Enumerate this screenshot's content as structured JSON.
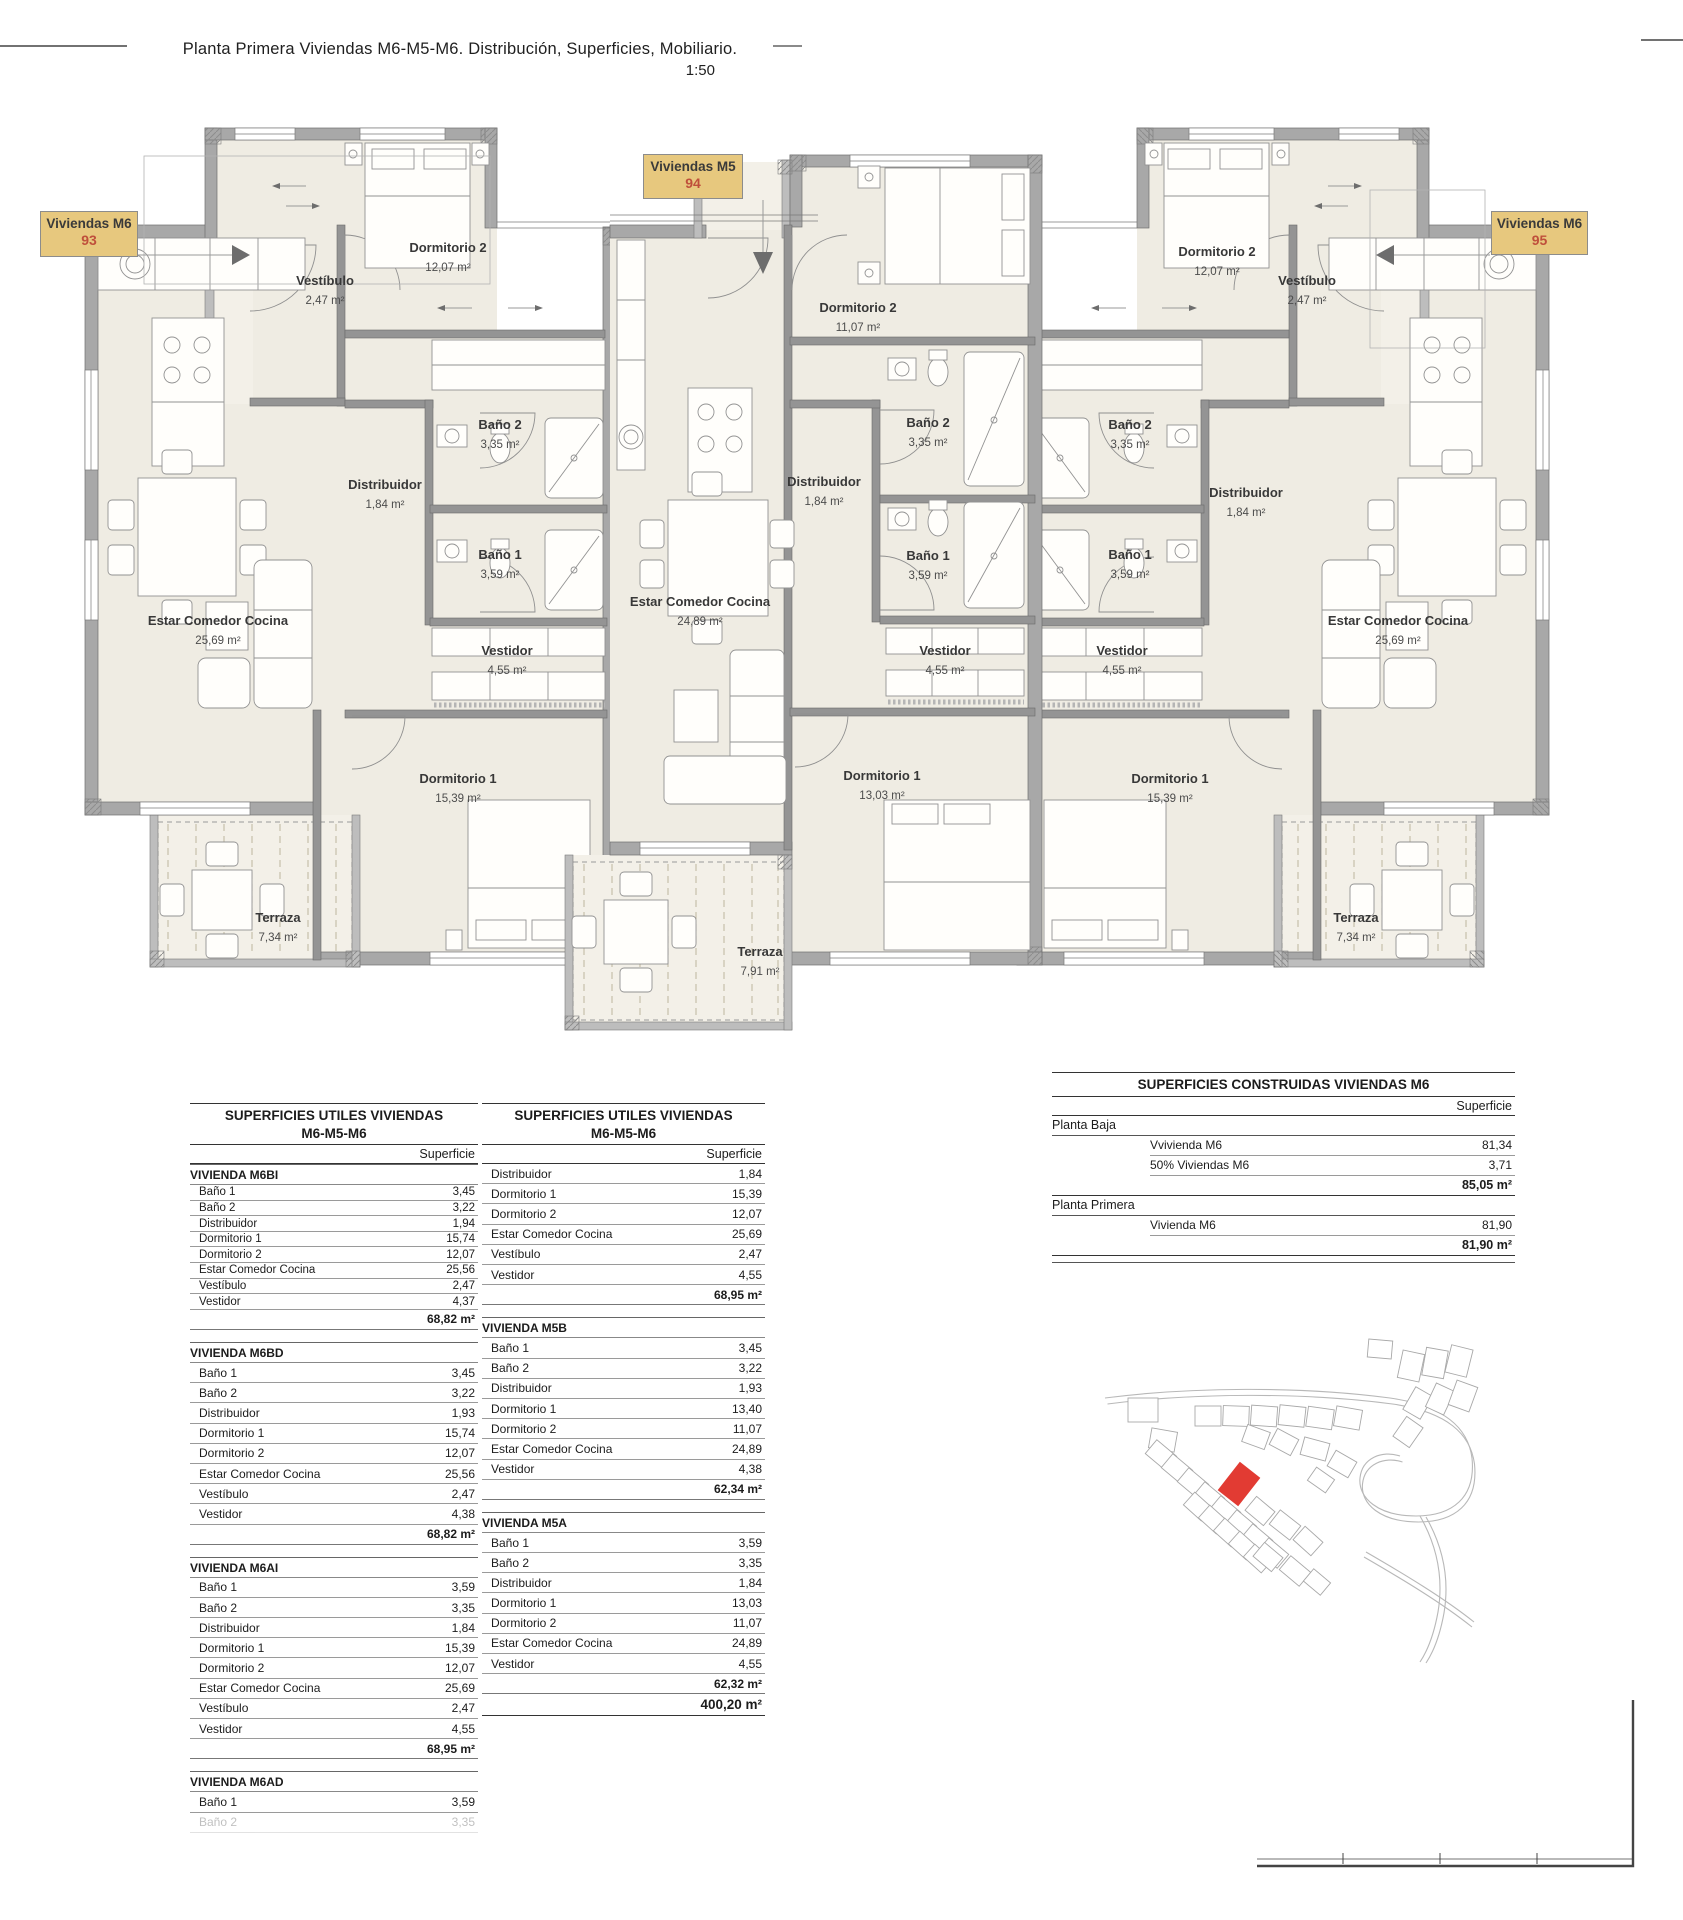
{
  "page": {
    "title": "Planta Primera Viviendas M6-M5-M6. Distribución, Superficies, Mobiliario.",
    "scale": "1:50"
  },
  "colors": {
    "tag_background": "#e7c87e",
    "tag_number": "#bf4f3b",
    "site_map_highlight": "#e23b33",
    "room_fill": "#efece3",
    "wall_gray": "#a8a8a8"
  },
  "unit_tags": [
    {
      "label": "Viviendas M6",
      "number": "93"
    },
    {
      "label": "Viviendas M5",
      "number": "94"
    },
    {
      "label": "Viviendas M6",
      "number": "95"
    }
  ],
  "plan": {
    "rooms": [
      {
        "unit": "m6-93",
        "name": "Vestíbulo",
        "area": "2,47 m²",
        "x": 325,
        "y": 285
      },
      {
        "unit": "m6-93",
        "name": "Dormitorio 2",
        "area": "12,07 m²",
        "x": 448,
        "y": 252
      },
      {
        "unit": "m6-93",
        "name": "Distribuidor",
        "area": "1,84 m²",
        "x": 385,
        "y": 489
      },
      {
        "unit": "m6-93",
        "name": "Baño 2",
        "area": "3,35 m²",
        "x": 500,
        "y": 429
      },
      {
        "unit": "m6-93",
        "name": "Baño 1",
        "area": "3,59 m²",
        "x": 500,
        "y": 559
      },
      {
        "unit": "m6-93",
        "name": "Vestidor",
        "area": "4,55 m²",
        "x": 507,
        "y": 655
      },
      {
        "unit": "m6-93",
        "name": "Estar Comedor Cocina",
        "area": "25,69 m²",
        "x": 218,
        "y": 625
      },
      {
        "unit": "m6-93",
        "name": "Dormitorio 1",
        "area": "15,39 m²",
        "x": 458,
        "y": 783
      },
      {
        "unit": "m6-93",
        "name": "Terraza",
        "area": "7,34 m²",
        "x": 278,
        "y": 922
      },
      {
        "unit": "m5-94",
        "name": "Dormitorio 2",
        "area": "11,07 m²",
        "x": 858,
        "y": 312
      },
      {
        "unit": "m5-94",
        "name": "Distribuidor",
        "area": "1,84 m²",
        "x": 824,
        "y": 486
      },
      {
        "unit": "m5-94",
        "name": "Baño 2",
        "area": "3,35 m²",
        "x": 928,
        "y": 427
      },
      {
        "unit": "m5-94",
        "name": "Baño 1",
        "area": "3,59 m²",
        "x": 928,
        "y": 560
      },
      {
        "unit": "m5-94",
        "name": "Vestidor",
        "area": "4,55 m²",
        "x": 945,
        "y": 655
      },
      {
        "unit": "m5-94",
        "name": "Estar Comedor Cocina",
        "area": "24,89 m²",
        "x": 700,
        "y": 606
      },
      {
        "unit": "m5-94",
        "name": "Dormitorio 1",
        "area": "13,03 m²",
        "x": 882,
        "y": 780
      },
      {
        "unit": "m5-94",
        "name": "Terraza",
        "area": "7,91 m²",
        "x": 760,
        "y": 956
      },
      {
        "unit": "m6-95",
        "name": "Vestíbulo",
        "area": "2,47 m²",
        "x": 1307,
        "y": 285
      },
      {
        "unit": "m6-95",
        "name": "Dormitorio 2",
        "area": "12,07 m²",
        "x": 1217,
        "y": 256
      },
      {
        "unit": "m6-95",
        "name": "Distribuidor",
        "area": "1,84 m²",
        "x": 1246,
        "y": 497
      },
      {
        "unit": "m6-95",
        "name": "Baño 2",
        "area": "3,35 m²",
        "x": 1130,
        "y": 429
      },
      {
        "unit": "m6-95",
        "name": "Baño 1",
        "area": "3,59 m²",
        "x": 1130,
        "y": 559
      },
      {
        "unit": "m6-95",
        "name": "Vestidor",
        "area": "4,55 m²",
        "x": 1122,
        "y": 655
      },
      {
        "unit": "m6-95",
        "name": "Estar Comedor Cocina",
        "area": "25,69 m²",
        "x": 1398,
        "y": 625
      },
      {
        "unit": "m6-95",
        "name": "Dormitorio 1",
        "area": "15,39 m²",
        "x": 1170,
        "y": 783
      },
      {
        "unit": "m6-95",
        "name": "Terraza",
        "area": "7,34 m²",
        "x": 1356,
        "y": 922
      }
    ]
  },
  "tables": {
    "utiles_left": {
      "title1": "SUPERFICIES UTILES VIVIENDAS",
      "title2": "M6-M5-M6",
      "col_header": "Superficie",
      "sections": [
        {
          "name": "VIVIENDA M6BI",
          "rows": [
            [
              "Baño 1",
              "3,45"
            ],
            [
              "Baño 2",
              "3,22"
            ],
            [
              "Distribuidor",
              "1,94"
            ],
            [
              "Dormitorio 1",
              "15,74"
            ],
            [
              "Dormitorio 2",
              "12,07"
            ],
            [
              "Estar Comedor Cocina",
              "25,56"
            ],
            [
              "Vestíbulo",
              "2,47"
            ],
            [
              "Vestidor",
              "4,37"
            ]
          ],
          "total": "68,82 m²"
        },
        {
          "name": "VIVIENDA M6BD",
          "rows": [
            [
              "Baño 1",
              "3,45"
            ],
            [
              "Baño 2",
              "3,22"
            ],
            [
              "Distribuidor",
              "1,93"
            ],
            [
              "Dormitorio 1",
              "15,74"
            ],
            [
              "Dormitorio 2",
              "12,07"
            ],
            [
              "Estar Comedor Cocina",
              "25,56"
            ],
            [
              "Vestíbulo",
              "2,47"
            ],
            [
              "Vestidor",
              "4,38"
            ]
          ],
          "total": "68,82 m²"
        },
        {
          "name": "VIVIENDA M6AI",
          "rows": [
            [
              "Baño 1",
              "3,59"
            ],
            [
              "Baño 2",
              "3,35"
            ],
            [
              "Distribuidor",
              "1,84"
            ],
            [
              "Dormitorio 1",
              "15,39"
            ],
            [
              "Dormitorio 2",
              "12,07"
            ],
            [
              "Estar Comedor Cocina",
              "25,69"
            ],
            [
              "Vestíbulo",
              "2,47"
            ],
            [
              "Vestidor",
              "4,55"
            ]
          ],
          "total": "68,95 m²"
        },
        {
          "name": "VIVIENDA M6AD",
          "rows": [
            [
              "Baño 1",
              "3,59"
            ]
          ],
          "partial_row": [
            "Baño 2",
            "3,35"
          ],
          "total": null
        }
      ]
    },
    "utiles_right": {
      "title1": "SUPERFICIES UTILES VIVIENDAS",
      "title2": "M6-M5-M6",
      "col_header": "Superficie",
      "sections": [
        {
          "name": null,
          "rows": [
            [
              "Distribuidor",
              "1,84"
            ],
            [
              "Dormitorio 1",
              "15,39"
            ],
            [
              "Dormitorio 2",
              "12,07"
            ],
            [
              "Estar Comedor Cocina",
              "25,69"
            ],
            [
              "Vestíbulo",
              "2,47"
            ],
            [
              "Vestidor",
              "4,55"
            ]
          ],
          "total": "68,95 m²"
        },
        {
          "name": "VIVIENDA M5B",
          "rows": [
            [
              "Baño 1",
              "3,45"
            ],
            [
              "Baño 2",
              "3,22"
            ],
            [
              "Distribuidor",
              "1,93"
            ],
            [
              "Dormitorio 1",
              "13,40"
            ],
            [
              "Dormitorio 2",
              "11,07"
            ],
            [
              "Estar Comedor Cocina",
              "24,89"
            ],
            [
              "Vestidor",
              "4,38"
            ]
          ],
          "total": "62,34 m²"
        },
        {
          "name": "VIVIENDA M5A",
          "rows": [
            [
              "Baño 1",
              "3,59"
            ],
            [
              "Baño 2",
              "3,35"
            ],
            [
              "Distribuidor",
              "1,84"
            ],
            [
              "Dormitorio 1",
              "13,03"
            ],
            [
              "Dormitorio 2",
              "11,07"
            ],
            [
              "Estar Comedor Cocina",
              "24,89"
            ],
            [
              "Vestidor",
              "4,55"
            ]
          ],
          "total": "62,32 m²"
        }
      ],
      "grand_total": "400,20 m²"
    },
    "construidas": {
      "title": "SUPERFICIES CONSTRUIDAS VIVIENDAS M6",
      "col_header": "Superficie",
      "groups": [
        {
          "name": "Planta Baja",
          "rows": [
            [
              "Vvivienda M6",
              "81,34"
            ],
            [
              "50% Viviendas M6",
              "3,71"
            ]
          ],
          "total": "85,05 m²"
        },
        {
          "name": "Planta Primera",
          "rows": [
            [
              "Vivienda M6",
              "81,90"
            ]
          ],
          "total": "81,90 m²"
        }
      ]
    }
  }
}
